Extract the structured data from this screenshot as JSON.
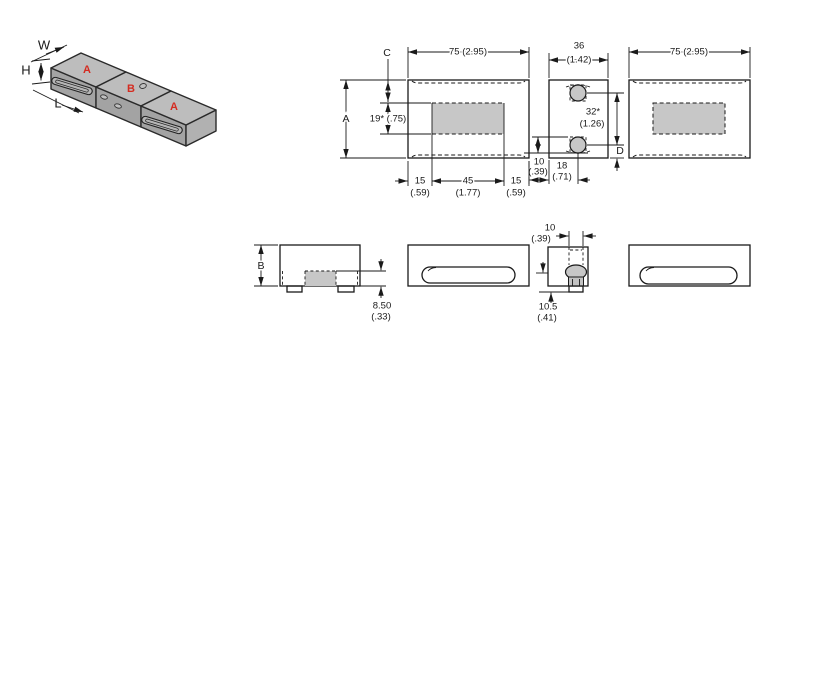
{
  "iso": {
    "label_w": "W",
    "label_h": "H",
    "label_l": "L",
    "block_a1": "A",
    "block_b": "B",
    "block_a2": "A"
  },
  "front_view": {
    "dim_width": "75 (2.95)",
    "label_c": "C",
    "label_a": "A",
    "dim_recess": "19* (.75)",
    "dim_left": "15",
    "dim_left_in": "(.59)",
    "dim_center": "45",
    "dim_center_in": "(1.77)",
    "dim_right": "15",
    "dim_right_in": "(.59)"
  },
  "end_view": {
    "dim_width": "36",
    "dim_width_in": "(1.42)",
    "dim_pitch": "32*",
    "dim_pitch_in": "(1.26)",
    "dim_hole": "10",
    "dim_hole_in": "(.39)",
    "dim_offset": "18",
    "dim_offset_in": "(.71)",
    "label_d": "D"
  },
  "back_view": {
    "dim_width": "75 (2.95)"
  },
  "profile_view": {
    "label_b": "B",
    "dim_depth": "8.50",
    "dim_depth_in": "(.33)"
  },
  "end_profile_view": {
    "dim_channel": "10",
    "dim_channel_in": "(.39)",
    "dim_height": "10.5",
    "dim_height_in": "(.41)"
  },
  "colors": {
    "gray": "#c7c7c7",
    "red": "#d42b20",
    "iso-top": "#bdbdbd",
    "iso-front": "#a3a3a3",
    "iso-side": "#b1b1b1"
  }
}
